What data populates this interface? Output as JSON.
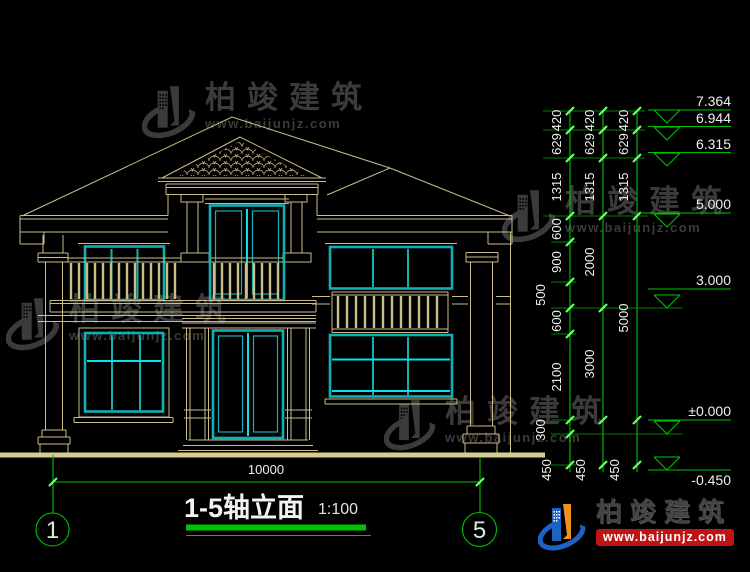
{
  "watermark": {
    "brand": "柏竣建筑",
    "url": "www.baijunjz.com"
  },
  "logo": {
    "brand": "柏竣建筑",
    "url": "www.baijunjz.com"
  },
  "drawing_title": {
    "name": "1-5轴立面",
    "scale": "1:100"
  },
  "bottom_dim": {
    "total_width": "10000"
  },
  "axis_bubbles": {
    "left": "1",
    "right": "5"
  },
  "levels": [
    "7.364",
    "6.944",
    "6.315",
    "5.000",
    "3.000",
    "±0.000",
    "-0.450"
  ],
  "dims": {
    "col1": [
      "420",
      "629",
      "1315",
      "600",
      "900",
      "500",
      "600",
      "2100",
      "300",
      "450"
    ],
    "col2": [
      "420",
      "629",
      "1315",
      "2000",
      "3000",
      "450"
    ],
    "col3": [
      "420",
      "629",
      "1315",
      "5000",
      "450"
    ]
  },
  "colors": {
    "line_tan": "#C9BE88",
    "window_cyan": "#13AFB5",
    "window_cyan_bright": "#00E4EA",
    "annotation_green": "#00C300",
    "tick_green": "#6CFF6C",
    "text_white": "#EFEFEF",
    "watermark_gray": "#3B3B3B",
    "logo_blue": "#1E63C4",
    "logo_orange": "#F0921E",
    "logo_red": "#C01414"
  }
}
